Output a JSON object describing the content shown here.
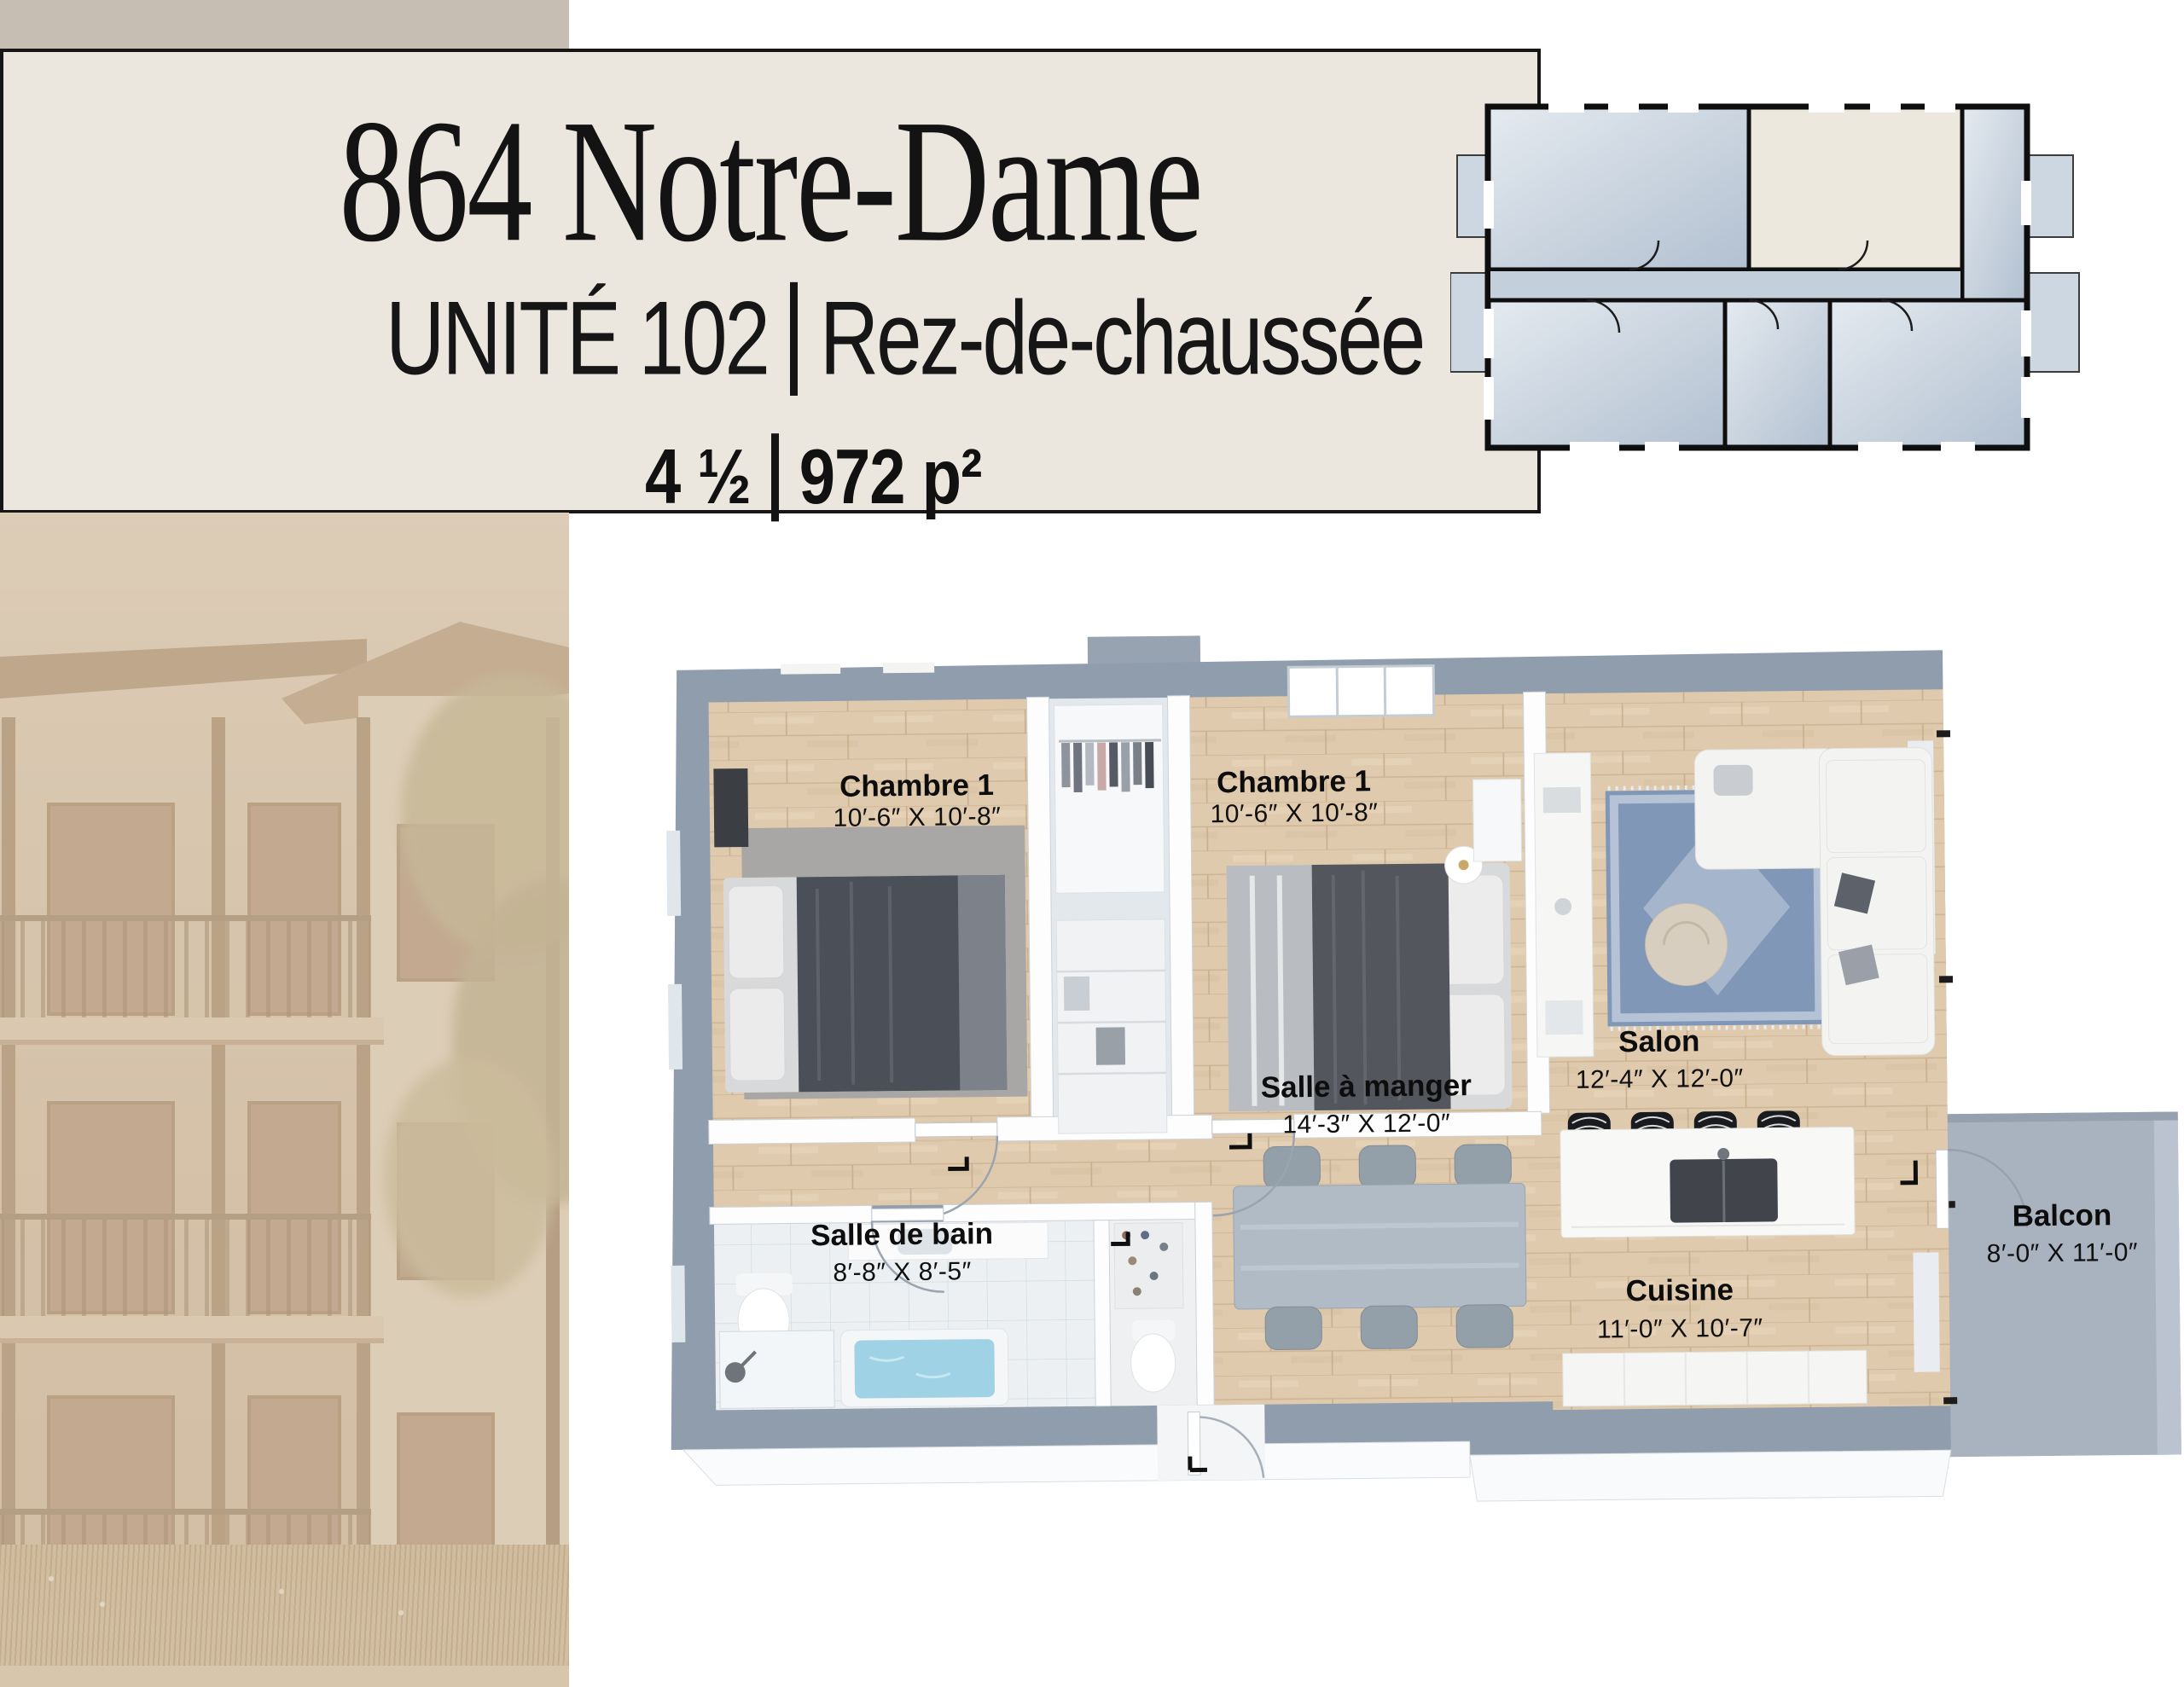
{
  "header": {
    "title": "864 Notre-Dame",
    "unit": "UNITÉ 102",
    "separator": "|",
    "floor": "Rez-de-chaussée",
    "config": "4 ½",
    "area": "972 p²"
  },
  "floor_plan": {
    "rooms": [
      {
        "name": "Chambre 1",
        "dims": "10′-6″ X 10′-8″"
      },
      {
        "name": "Chambre 1",
        "dims": "10′-6″ X 10′-8″"
      },
      {
        "name": "Salle à manger",
        "dims": "14′-3″ X 12′-0″"
      },
      {
        "name": "Salon",
        "dims": "12′-4″ X 12′-0″"
      },
      {
        "name": "Salle de bain",
        "dims": "8′-8″ X 8′-5″"
      },
      {
        "name": "Cuisine",
        "dims": "11′-0″ X 10′-7″"
      },
      {
        "name": "Balcon",
        "dims": "8′-0″ X 11′-0″"
      }
    ]
  },
  "colors": {
    "tan_block": "#c6beb2",
    "header_bg": "#ebe7de",
    "border": "#161616",
    "wall_blue_gray": "#8f9dad",
    "wood_floor": "#dfcaae",
    "key_plan_room": "#c2cfdc",
    "key_plan_highlight": "#ece8dd",
    "balcony_slab": "#a9b3c0",
    "rug_blue": "#8197b7"
  }
}
